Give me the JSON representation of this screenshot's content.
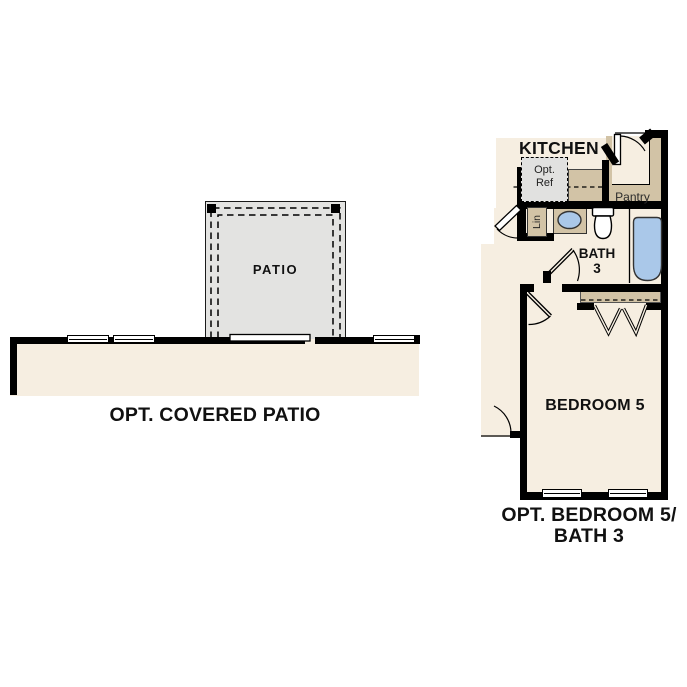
{
  "colors": {
    "wall": "#000000",
    "interior_cream": "#f6eee1",
    "patio_gray": "#e3e3e1",
    "fixture_tan": "#d2c3a6",
    "water_blue": "#aac8e9",
    "optref_gray": "#e1e1e0",
    "text_black": "#111111"
  },
  "patio_plan": {
    "room_label": "PATIO",
    "caption": "OPT. COVERED PATIO"
  },
  "bedroom_plan": {
    "kitchen_label": "KITCHEN",
    "opt_ref_line1": "Opt.",
    "opt_ref_line2": "Ref",
    "pantry_label": "Pantry",
    "linen_label": "Lin",
    "bath_line1": "BATH",
    "bath_line2": "3",
    "bedroom_label": "BEDROOM 5",
    "caption_line1": "OPT. BEDROOM 5/",
    "caption_line2": "BATH 3"
  }
}
